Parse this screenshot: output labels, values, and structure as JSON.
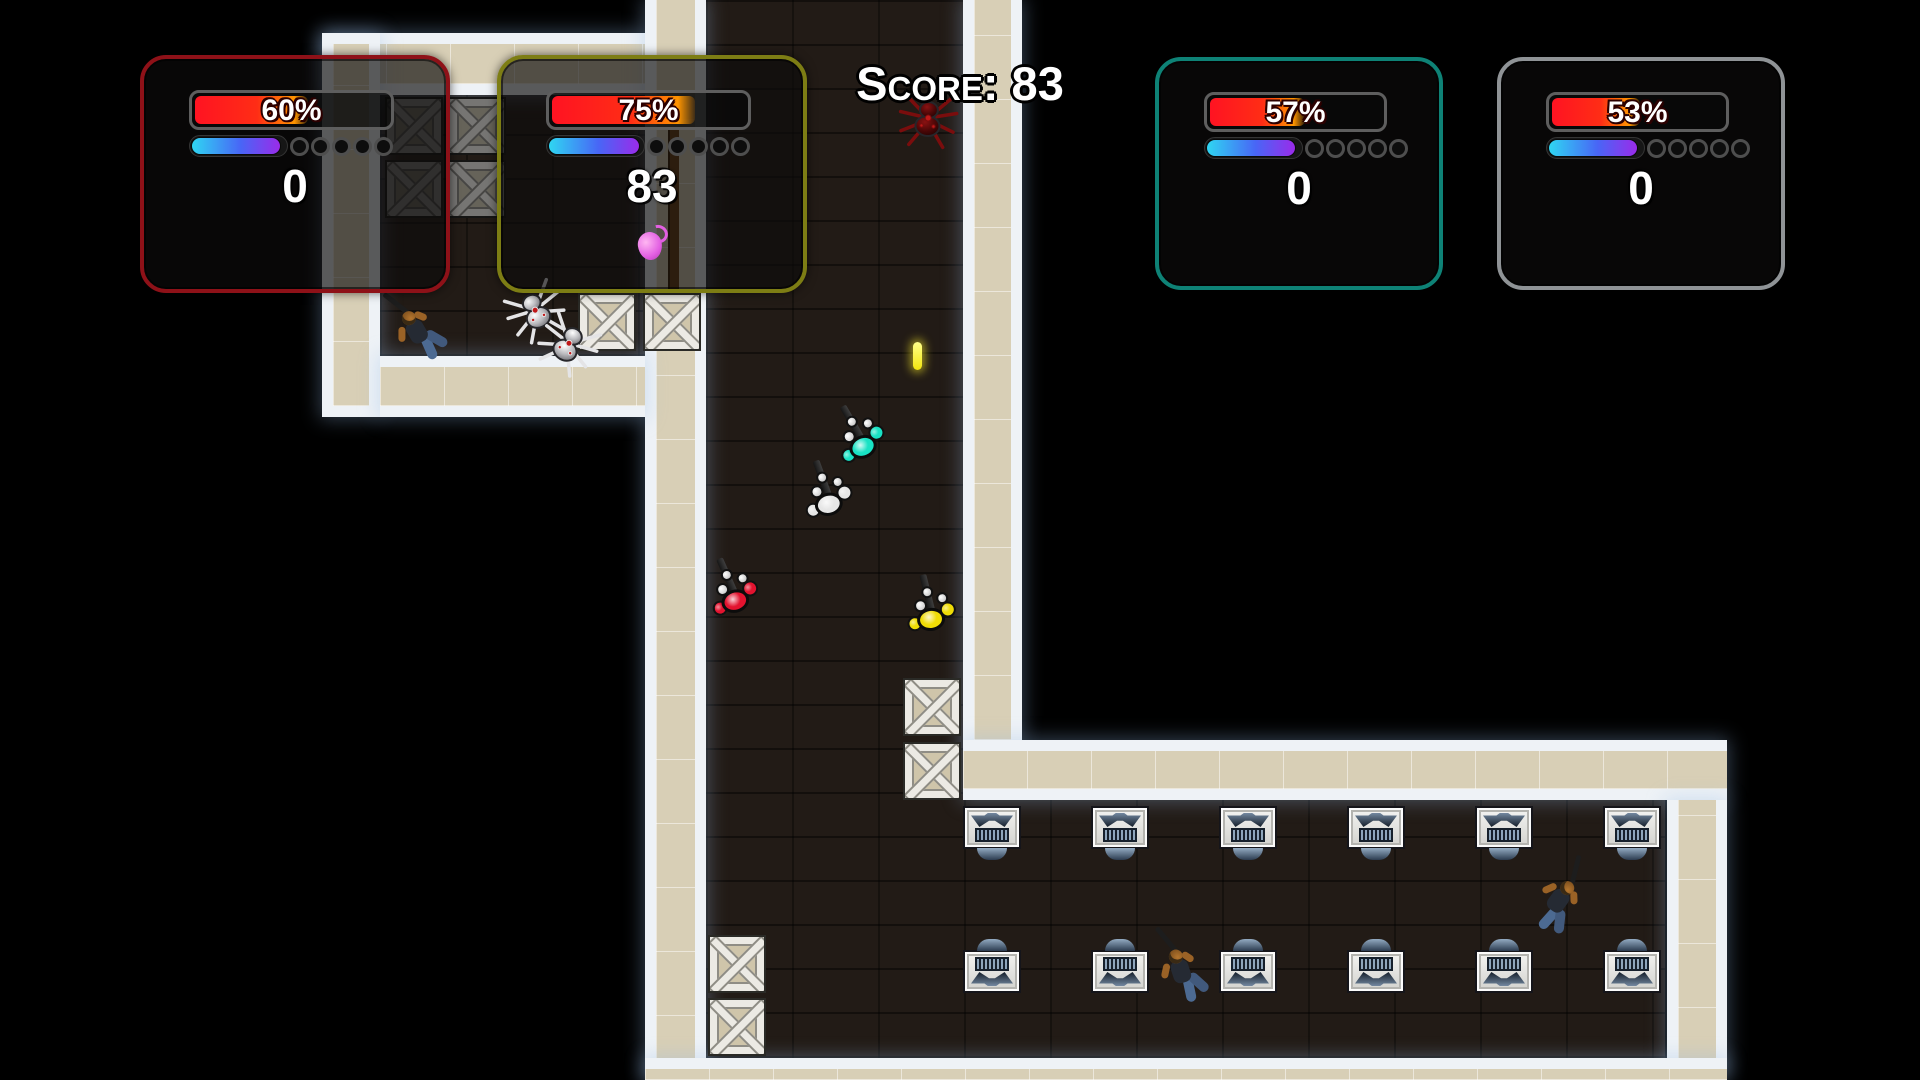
{
  "scene": {
    "width": 1920,
    "height": 1080,
    "background": "#000000"
  },
  "hud": {
    "score_banner": "Score: 83",
    "panels": [
      {
        "name": "player-panel-red",
        "accent": "#8e1118",
        "x": 140,
        "y": 55,
        "w": 310,
        "h": 238,
        "health_pct": 60,
        "health_label": "60%",
        "energy_pct": 95,
        "ammo_slots": 5,
        "score": "0",
        "grenade": false
      },
      {
        "name": "player-panel-yellow",
        "accent": "#7d7d14",
        "x": 497,
        "y": 55,
        "w": 310,
        "h": 238,
        "health_pct": 75,
        "health_label": "75%",
        "energy_pct": 97,
        "ammo_slots": 5,
        "score": "83",
        "grenade": true
      },
      {
        "name": "player-panel-teal",
        "accent": "#0e8276",
        "x": 1155,
        "y": 57,
        "w": 288,
        "h": 233,
        "health_pct": 57,
        "health_label": "57%",
        "energy_pct": 95,
        "ammo_slots": 5,
        "score": "0",
        "grenade": false
      },
      {
        "name": "player-panel-gray",
        "accent": "#8f9396",
        "x": 1497,
        "y": 57,
        "w": 288,
        "h": 233,
        "health_pct": 53,
        "health_label": "53%",
        "energy_pct": 95,
        "ammo_slots": 5,
        "score": "0",
        "grenade": false
      }
    ]
  },
  "map": {
    "floors": [
      {
        "name": "room-upper-left-floor",
        "x": 380,
        "y": 33,
        "w": 268,
        "h": 323
      },
      {
        "name": "corridor-floor",
        "x": 706,
        "y": 0,
        "w": 257,
        "h": 1058
      },
      {
        "name": "desk-room-floor",
        "x": 706,
        "y": 798,
        "w": 959,
        "h": 260
      }
    ],
    "walls": [
      {
        "name": "room-top-wall",
        "x": 322,
        "y": 33,
        "w": 323,
        "h": 62,
        "edges": "tb"
      },
      {
        "name": "room-left-wall",
        "x": 322,
        "y": 33,
        "w": 58,
        "h": 384,
        "edges": "all"
      },
      {
        "name": "corridor-left-wall",
        "x": 645,
        "y": 0,
        "w": 61,
        "h": 1080,
        "edges": "lr"
      },
      {
        "name": "room-bottom-wall",
        "x": 380,
        "y": 356,
        "w": 265,
        "h": 61,
        "edges": "tb"
      },
      {
        "name": "corridor-right-wall",
        "x": 963,
        "y": 0,
        "w": 59,
        "h": 740,
        "edges": "lr"
      },
      {
        "name": "desk-room-top-wall",
        "x": 963,
        "y": 740,
        "w": 764,
        "h": 60,
        "edges": "tb"
      },
      {
        "name": "desk-room-right-wall",
        "x": 1667,
        "y": 800,
        "w": 60,
        "h": 272,
        "edges": "lr"
      },
      {
        "name": "bottom-wall",
        "x": 645,
        "y": 1058,
        "w": 1082,
        "h": 22,
        "edges": "t"
      }
    ],
    "crates": [
      {
        "x": 385,
        "y": 97,
        "dark": true
      },
      {
        "x": 448,
        "y": 97,
        "dark": true
      },
      {
        "x": 385,
        "y": 160,
        "dark": true
      },
      {
        "x": 448,
        "y": 160,
        "dark": true
      },
      {
        "x": 578,
        "y": 293,
        "dark": false
      },
      {
        "x": 643,
        "y": 293,
        "dark": false
      },
      {
        "x": 903,
        "y": 678,
        "dark": false
      },
      {
        "x": 903,
        "y": 742,
        "dark": false
      },
      {
        "x": 708,
        "y": 935,
        "dark": false
      },
      {
        "x": 708,
        "y": 998,
        "dark": false
      }
    ],
    "desk_columns": [
      992,
      1120,
      1248,
      1376,
      1504,
      1632
    ],
    "desk_rows": [
      {
        "y": 806,
        "facing": "down"
      },
      {
        "y": 950,
        "facing": "up"
      }
    ],
    "soldiers": [
      {
        "color": "#19e2c4",
        "x": 860,
        "y": 440,
        "rot": -24
      },
      {
        "color": "#e6e6e6",
        "x": 827,
        "y": 497,
        "rot": -14
      },
      {
        "color": "#e3132f",
        "x": 733,
        "y": 594,
        "rot": -18
      },
      {
        "color": "#efdc06",
        "x": 930,
        "y": 612,
        "rot": -8
      }
    ],
    "bodies": [
      {
        "x": 417,
        "y": 322,
        "rot": -38
      },
      {
        "x": 1183,
        "y": 962,
        "rot": -26
      },
      {
        "x": 1567,
        "y": 897,
        "rot": 28
      }
    ],
    "spiders": [
      {
        "x": 536,
        "y": 312,
        "rot": -25,
        "variant": "silver"
      },
      {
        "x": 568,
        "y": 345,
        "rot": 30,
        "variant": "silver"
      },
      {
        "x": 928,
        "y": 120,
        "rot": 5,
        "variant": "red"
      }
    ],
    "projectile": {
      "x": 913,
      "y": 342,
      "w": 9,
      "h": 28,
      "color": "#f2e50e"
    },
    "pole": {
      "x": 668,
      "y": 128,
      "w": 9,
      "h": 164,
      "color": "#6b4015"
    }
  },
  "palette": {
    "wall_fill": "#d8cfb6",
    "wall_edge": "#eef2f6",
    "floor": "#221b16",
    "health_red": "#ff1322",
    "health_orange": "#ff9500",
    "energy_start": "#2fd6f2",
    "energy_mid": "#4866f6",
    "energy_end": "#9a2bea",
    "grenade_pink": "#e25fe2"
  }
}
